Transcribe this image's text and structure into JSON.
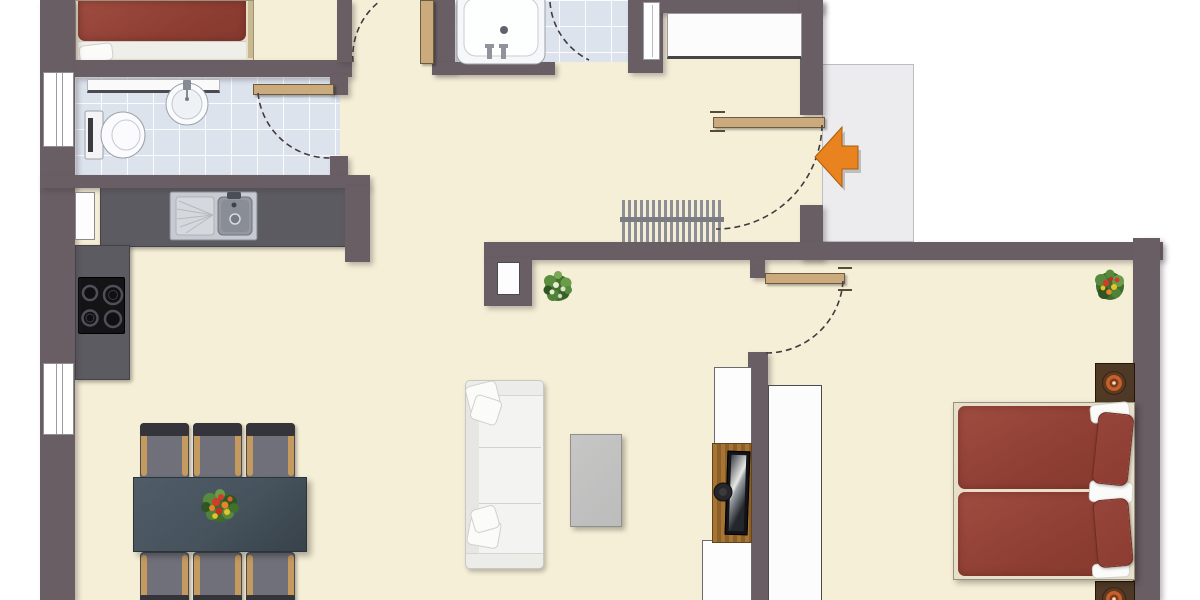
{
  "meta": {
    "type": "floor-plan",
    "description": "Top-down furnished apartment floor plan rendering, no text labels",
    "width_px": 1200,
    "height_px": 600
  },
  "colors": {
    "outside": "#ffffff",
    "floor": "#f6efd7",
    "wall": "#695e63",
    "wall-line": "#433a40",
    "tile": "#dce3ed",
    "counter": "#5c5b61",
    "appliance": "#141417",
    "steel": "#c7cad0",
    "fixture": "#fbfbfd",
    "door-wood": "#cbaa7e",
    "arrow": "#e8831f",
    "entry-floor": "#ececee",
    "radiator": "#8e8e95",
    "table": "#46525c",
    "chair-seat": "#70707a",
    "chair-back": "#34343a",
    "chair-arm": "#c49a5e",
    "sofa": "#f3f3f2",
    "coffee": "#bcbcbc",
    "bed-red": "#8e3e33",
    "pillow-red": "#8d3c31",
    "bed-frame": "#e7dfc9",
    "nightstand": "#4e3926",
    "lamp": "#c65f2a",
    "wood": "#a87434",
    "tv": "#141417",
    "closet": "#fcfcfc",
    "plant": "#4e8f3a",
    "flower-red": "#d23c2a",
    "flower-orange": "#e8842a",
    "flower-yellow": "#e8c22a"
  },
  "rooms": [
    {
      "id": "bedroom-top-left",
      "items": [
        "double-bed-red"
      ]
    },
    {
      "id": "wc-bathroom",
      "items": [
        "toilet",
        "round-washbasin",
        "shelf",
        "door-with-swing",
        "tiled-floor"
      ]
    },
    {
      "id": "bathroom",
      "items": [
        "bathtub",
        "towel-radiator",
        "door-with-swing",
        "tiled-floor"
      ]
    },
    {
      "id": "kitchen",
      "items": [
        "l-shaped-counter",
        "double-sink",
        "cooktop-4-burners",
        "wall-niche"
      ]
    },
    {
      "id": "entrance-hall",
      "items": [
        "wardrobe",
        "radiator",
        "entrance-door-with-swing"
      ]
    },
    {
      "id": "living-dining-room",
      "items": [
        "dining-table",
        "six-chairs",
        "flower-centerpiece",
        "sofa-white",
        "coffee-table",
        "tv-sideboard",
        "tv",
        "plant",
        "wall-niche"
      ]
    },
    {
      "id": "bedroom-right",
      "items": [
        "double-bed-red",
        "nightstand-top",
        "nightstand-bottom",
        "two-lamps",
        "closet",
        "plant",
        "door-with-swing"
      ]
    },
    {
      "id": "entry-landing",
      "items": [
        "orange-entrance-arrow"
      ]
    }
  ],
  "doors": [
    {
      "id": "entrance-door",
      "swing": "quarter-arc-into-hall"
    },
    {
      "id": "wc-door",
      "swing": "quarter-arc-into-wc"
    },
    {
      "id": "bathroom-door",
      "swing": "arc-into-bathroom"
    },
    {
      "id": "bedroom-right-door",
      "swing": "quarter-arc-into-bedroom"
    },
    {
      "id": "top-left-door",
      "swing": "partial-arc-cut-off"
    }
  ],
  "windows": [
    "left-wall-upper",
    "left-wall-lower"
  ],
  "entrance": {
    "indicator": "orange-arrow",
    "direction": "left-into-apartment"
  }
}
